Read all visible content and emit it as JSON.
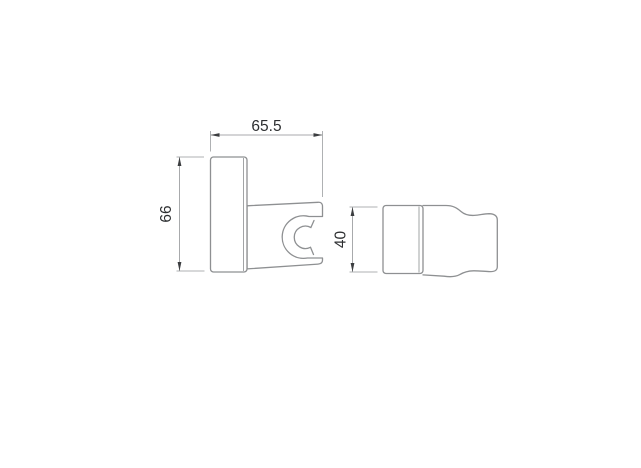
{
  "drawing": {
    "dimensions": {
      "side_width": "65.5",
      "side_height": "66",
      "front_height": "40"
    },
    "colors": {
      "background": "#ffffff",
      "outline": "#8e9092",
      "dimension_lines": "#a8aaac",
      "arrow_and_text": "#2d2f31"
    }
  }
}
